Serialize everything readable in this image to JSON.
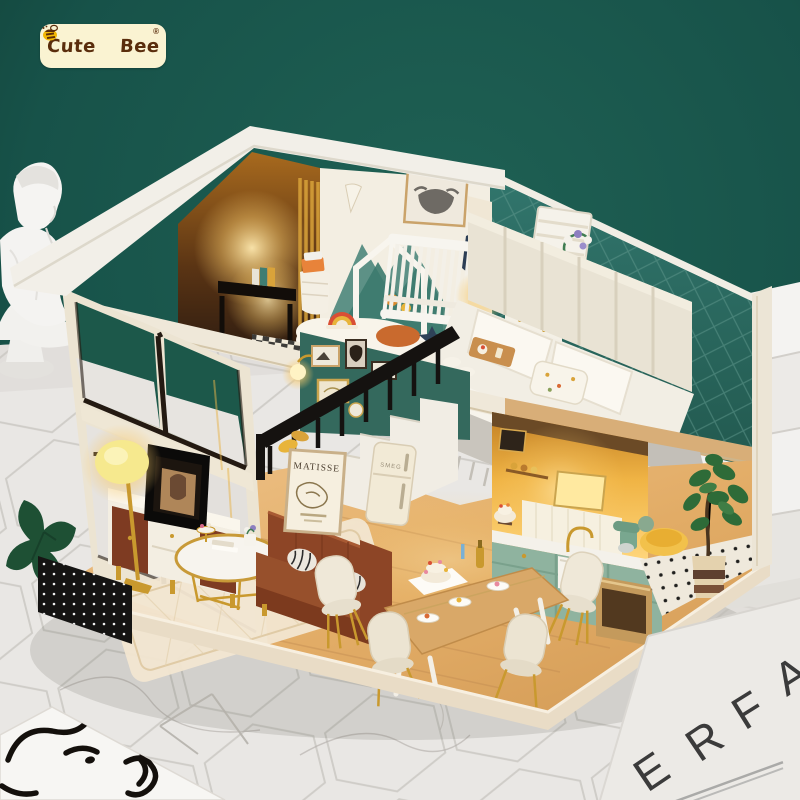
{
  "brand": {
    "prefix": "Cute",
    "suffix": "Bee",
    "registered_mark": "®",
    "logo_bg": "#FAF3D2",
    "logo_text_color": "#5A2D0C",
    "logo_accent_yellow": "#F2B705"
  },
  "posters": {
    "matisse_title": "MATISSE"
  },
  "appliances": {
    "fridge_brand": "SMEG"
  },
  "floor_page": {
    "letters": [
      "E",
      "R",
      "F",
      "A"
    ],
    "letter_color": "#3B3B3B"
  },
  "palette": {
    "backdrop_green": "#175249",
    "marble_white": "#E9E7E4",
    "roof_cream": "#F2EFE8",
    "bedroom_teal": "#2E6F66",
    "kitchen_cabinet_sage": "#8FB39F",
    "sofa_brown": "#8D4526",
    "warm_light": "#FFDF8E",
    "gold": "#C9992E",
    "wood_floor": "#E2B77F"
  },
  "scene": {
    "subject": "CUTEBEE DIY miniature dollhouse, two-story loft interior",
    "objects": [
      "plaster-bust",
      "marble-steps",
      "marble-hex-floor",
      "nursery-crib",
      "mountain-mural",
      "highland-cow-art",
      "bedroom-bed",
      "channel-headboard",
      "white-dresser",
      "wall-sconce",
      "window-wall",
      "tv-console",
      "television",
      "floor-lamp",
      "gold-coffee-table",
      "leather-sofa",
      "matisse-poster",
      "staircase-black-railing",
      "gallery-wall-frames",
      "retro-fridge",
      "kitchen-sink",
      "stand-mixer",
      "oven",
      "dining-table",
      "shell-chairs",
      "celebration-cake",
      "fiddle-leaf-fig",
      "magazine-page",
      "line-art-sketch"
    ]
  }
}
